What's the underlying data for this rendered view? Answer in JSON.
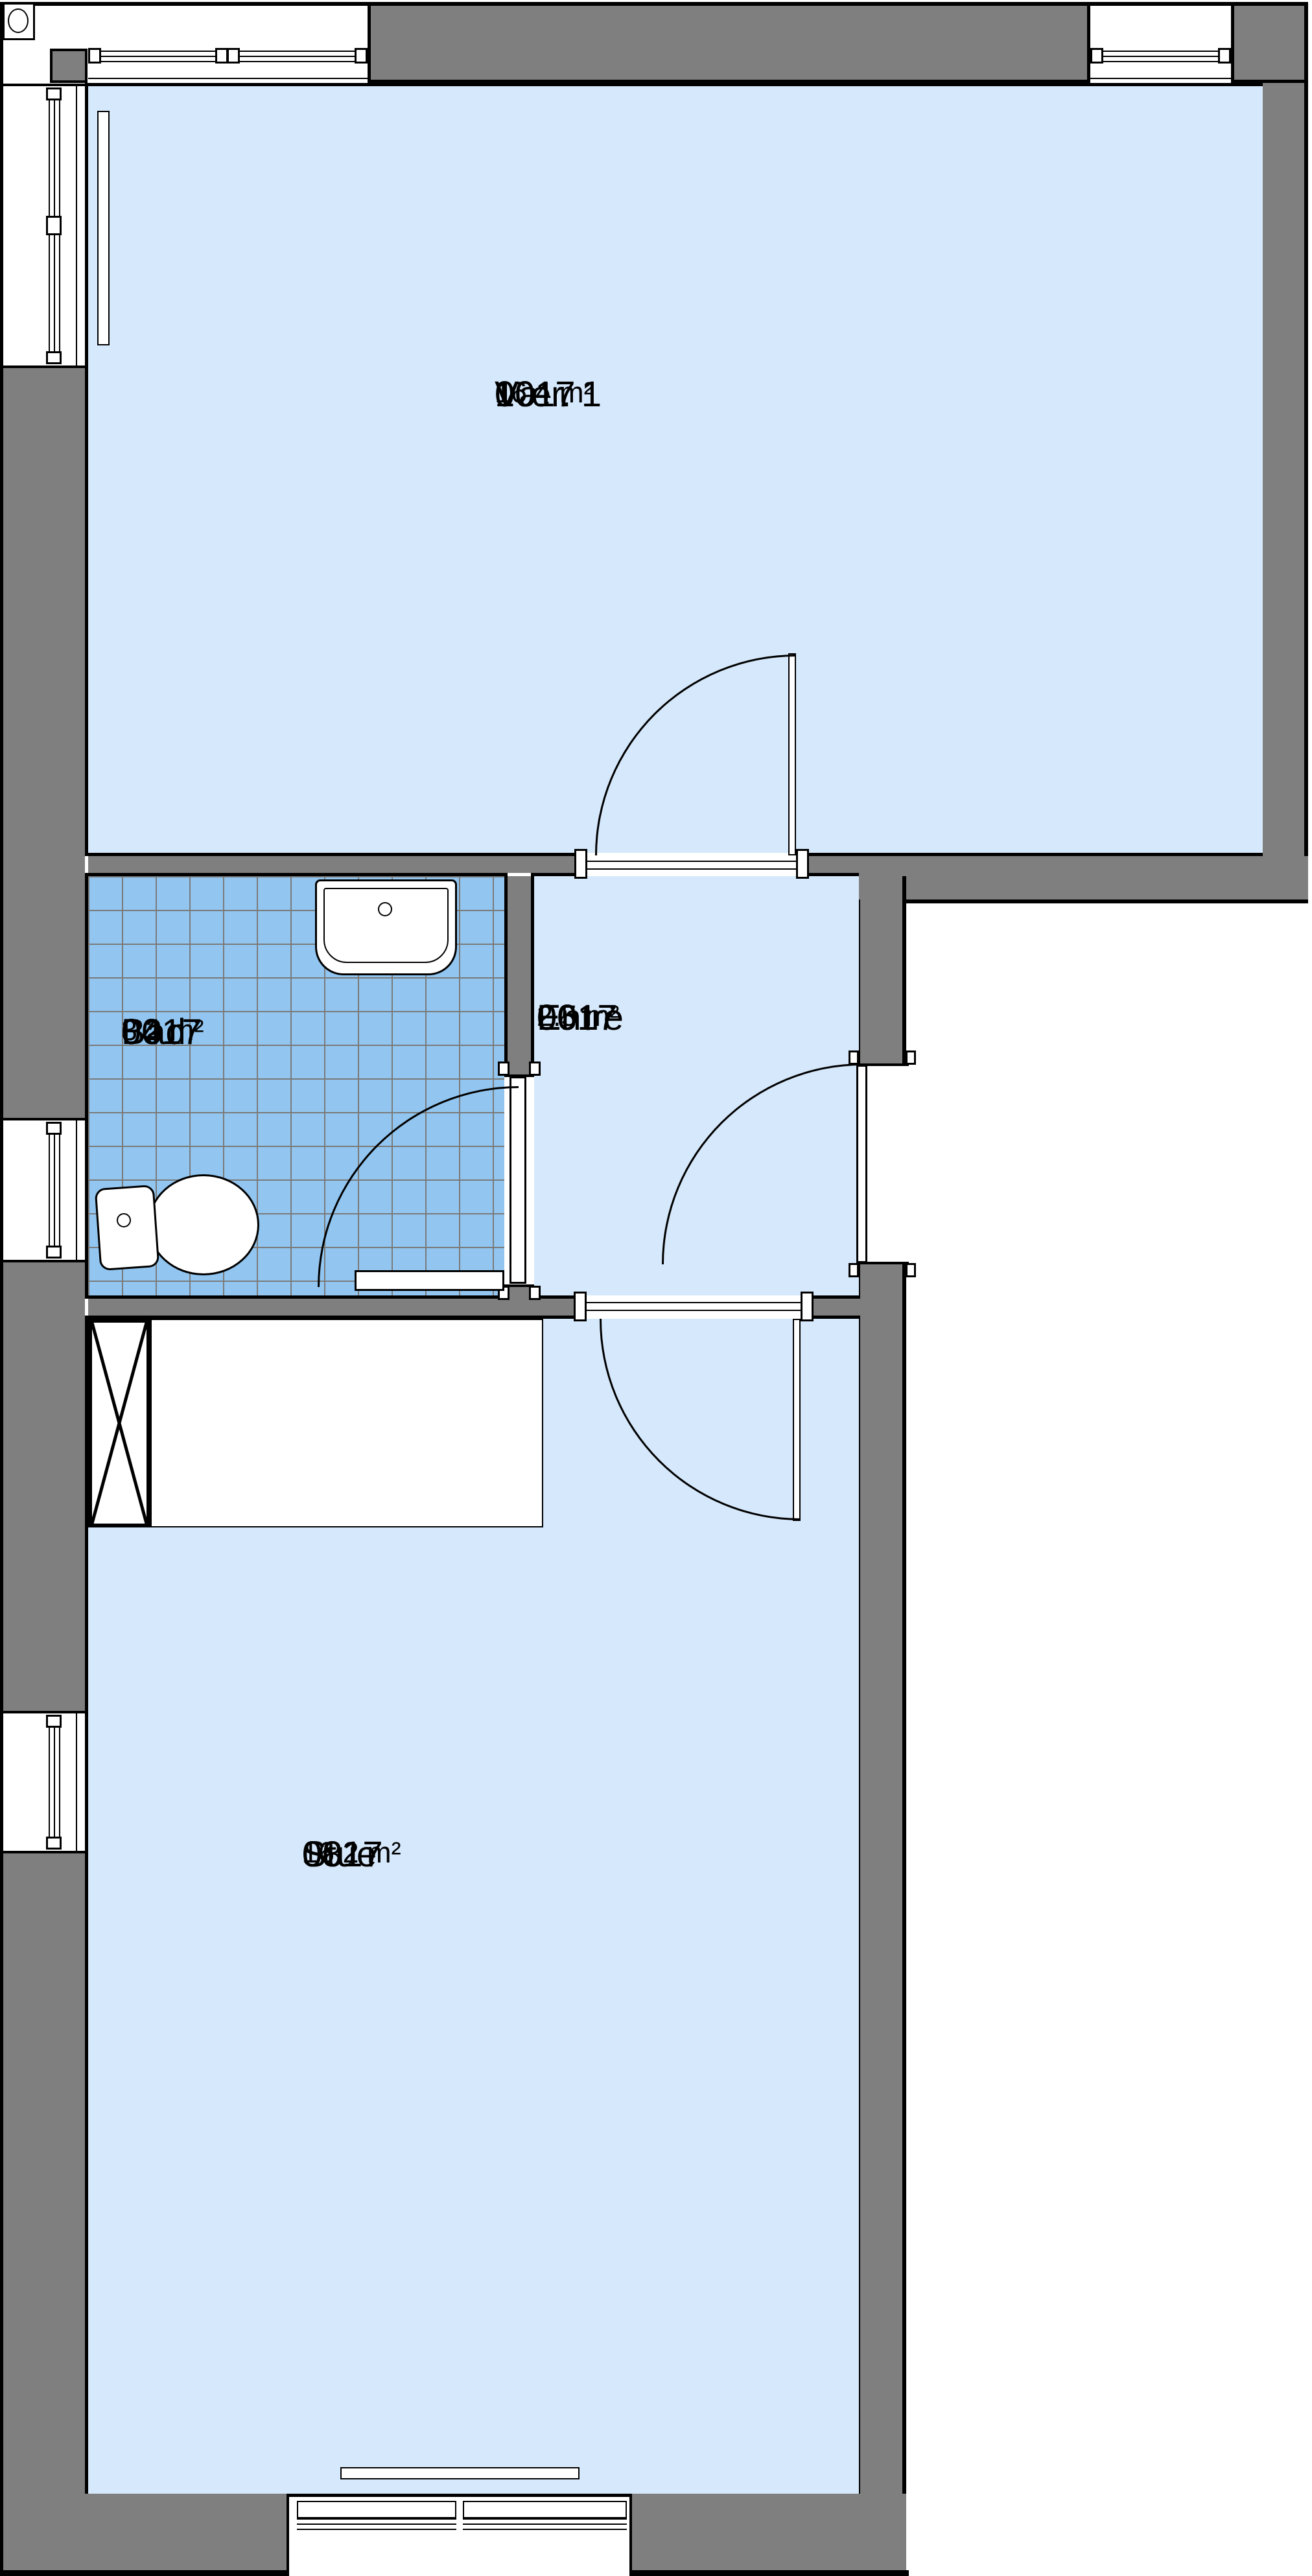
{
  "plan": {
    "type": "floor-plan",
    "rooms": [
      {
        "id": "0017",
        "unit": "10",
        "name": "Vær. 1",
        "area": "16.4 m²"
      },
      {
        "id": "0017",
        "unit": "04",
        "name": "Bad",
        "area": "3.2 m²"
      },
      {
        "id": "0017",
        "unit": "06",
        "name": "Entre",
        "area": "2.5 m²"
      },
      {
        "id": "0017",
        "unit": "08",
        "name": "Stue",
        "area": "16.2 m²"
      }
    ],
    "colors": {
      "room_fill": "#d6e8fb",
      "bath_tile_fill": "#92c6f0",
      "tile_grid_line": "#7a7a7a",
      "wall_fill": "#7f7f7f",
      "outline": "#000000",
      "background": "#ffffff"
    },
    "symbols": [
      "column-marker-icon",
      "window-symbol",
      "door-swing-arc",
      "washbasin",
      "toilet",
      "radiator",
      "shaft-cross",
      "kitchen-counter",
      "shower-strip"
    ]
  }
}
